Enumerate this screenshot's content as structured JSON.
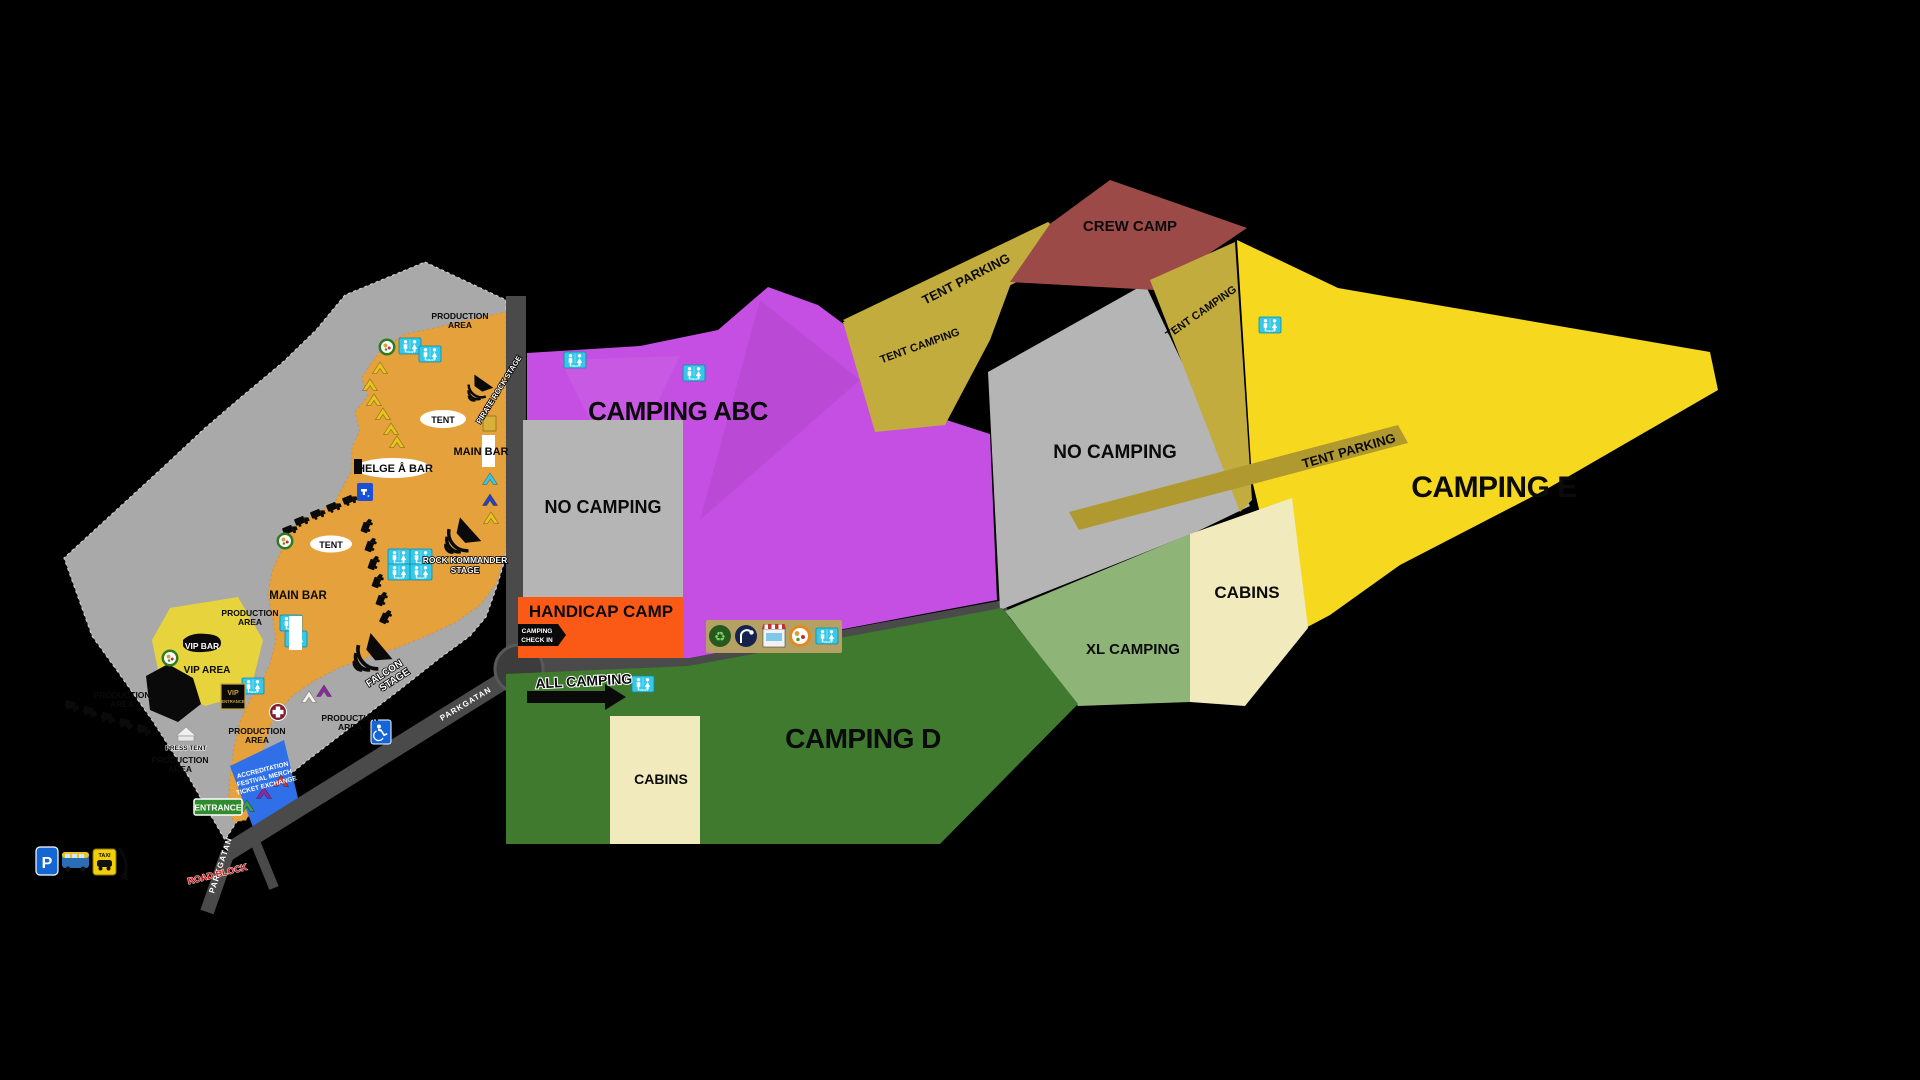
{
  "areas": {
    "camping_abc": "CAMPING ABC",
    "camping_d": "CAMPING D",
    "camping_e": "CAMPING E",
    "no_camping": "NO CAMPING",
    "handicap_camp": "HANDICAP CAMP",
    "crew_camp": "CREW CAMP",
    "tent_camping": "TENT CAMPING",
    "tent_parking": "TENT PARKING",
    "xl_camping": "XL CAMPING",
    "cabins": "CABINS",
    "vip_area": "VIP AREA",
    "production_area_line1": "PRODUCTION",
    "production_area_line2": "AREA"
  },
  "venues": {
    "main_bar": "MAIN BAR",
    "vip_bar": "VIP BAR",
    "helge_a_bar": "HELGE Å BAR",
    "tent": "TENT",
    "press_tent": "PRESS TENT",
    "falcon_stage_line1": "FALCON",
    "falcon_stage_line2": "STAGE",
    "rock_kommander_line1": "ROCK KOMMANDER",
    "rock_kommander_line2": "STAGE",
    "pirate_rock_stage": "PIRATE ROCK STAGE"
  },
  "signs": {
    "entrance": "ENTRANCE",
    "vip_entrance_line1": "VIP",
    "vip_entrance_line2": "ENTRANCE",
    "camping_check_in_line1": "CAMPING",
    "camping_check_in_line2": "CHECK IN",
    "all_camping": "ALL CAMPING",
    "accreditation_line1": "ACCREDITATION",
    "accreditation_line2": "FESTIVAL MERCH",
    "accreditation_line3": "TICKET EXCHANGE",
    "road_block": "ROAD BLOCK",
    "parkgatan": "PARKGATAN",
    "taxi": "TAXI",
    "parking_p": "P",
    "toilet": "TOILET"
  },
  "colors": {
    "background": "#000000",
    "festival_ground": "#a9a9a9",
    "festival_inner": "#e5a23c",
    "camping_abc_purple": "#c44fe2",
    "no_camping_gray": "#b5b5b5",
    "camping_d_green": "#3f7a2e",
    "xl_camping_green": "#8fb478",
    "cabins_cream": "#f1eabd",
    "camping_e_yellow": "#f6d91f",
    "tent_olive": "#c3ac3e",
    "tent_parking_olive": "#b0992f",
    "crew_camp_maroon": "#9b4a48",
    "handicap_orange": "#fa5a16",
    "vip_yellow": "#e7d33c",
    "accreditation_blue": "#2f6fe8",
    "toilet_cyan": "#35c8e8",
    "road_gray": "#4a4a4a",
    "entrance_green": "#2e8b2e"
  }
}
